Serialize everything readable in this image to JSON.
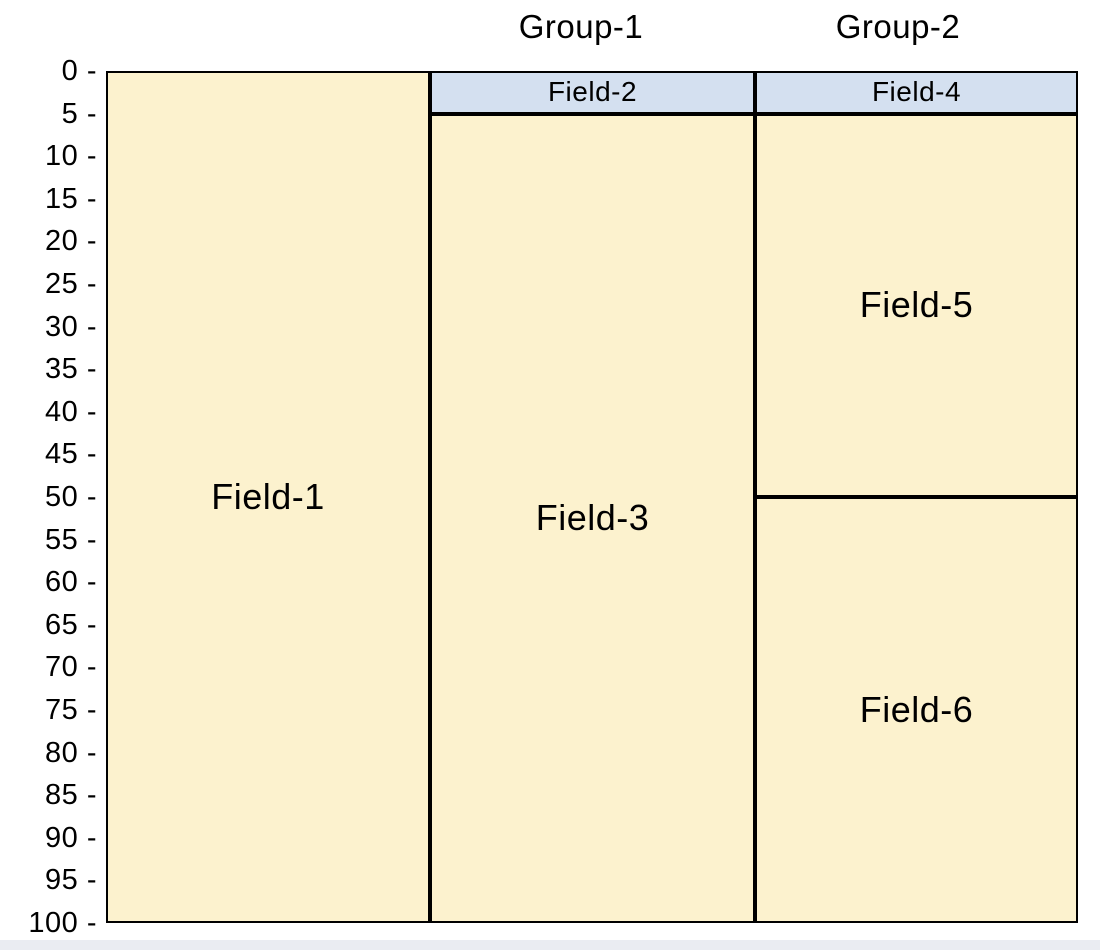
{
  "page": {
    "background": "#FFFFFF",
    "footer_strip_color": "#EAECF2"
  },
  "chart_data": {
    "type": "other",
    "chart_kind": "hierarchical-column-partition",
    "title": "",
    "xlabel": "",
    "ylabel": "",
    "y_axis": {
      "min": 0,
      "max": 100,
      "tick_step": 5,
      "direction": "top-down",
      "tick_format": "{v} -",
      "ticks": [
        0,
        5,
        10,
        15,
        20,
        25,
        30,
        35,
        40,
        45,
        50,
        55,
        60,
        65,
        70,
        75,
        80,
        85,
        90,
        95,
        100
      ]
    },
    "group_titles": [
      "Group-1",
      "Group-2"
    ],
    "columns": [
      {
        "group": "",
        "fields": [
          {
            "label": "Field-1",
            "start": 0,
            "end": 100,
            "fill": "cream"
          }
        ]
      },
      {
        "group": "Group-1",
        "fields": [
          {
            "label": "Field-2",
            "start": 0,
            "end": 5,
            "fill": "blue"
          },
          {
            "label": "Field-3",
            "start": 5,
            "end": 100,
            "fill": "cream"
          }
        ]
      },
      {
        "group": "Group-2",
        "fields": [
          {
            "label": "Field-4",
            "start": 0,
            "end": 5,
            "fill": "blue"
          },
          {
            "label": "Field-5",
            "start": 5,
            "end": 50,
            "fill": "cream"
          },
          {
            "label": "Field-6",
            "start": 50,
            "end": 100,
            "fill": "cream"
          }
        ]
      }
    ],
    "colors": {
      "cream": "#FCF2CE",
      "blue": "#D4E0F0",
      "border": "#000000",
      "text": "#000000"
    }
  }
}
